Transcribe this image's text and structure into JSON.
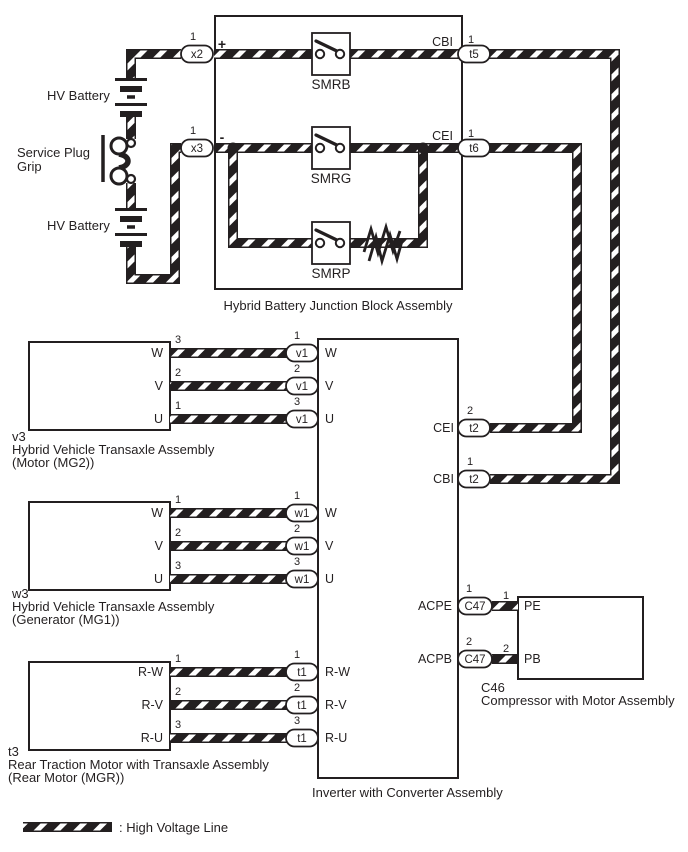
{
  "colors": {
    "ink": "#231f20",
    "background": "#ffffff",
    "hv_line_fill": "#ffffff"
  },
  "left_column": {
    "hv_battery_top": "HV Battery",
    "service_plug_line1": "Service Plug",
    "service_plug_line2": "Grip",
    "hv_battery_bottom": "HV Battery"
  },
  "junction_block": {
    "caption": "Hybrid Battery Junction Block Assembly",
    "x2": {
      "pin": "1",
      "label": "x2",
      "polarity": "+"
    },
    "x3": {
      "pin": "1",
      "label": "x3",
      "polarity": "-"
    },
    "t5": {
      "pin": "1",
      "label": "t5",
      "signal": "CBI"
    },
    "t6": {
      "pin": "1",
      "label": "t6",
      "signal": "CEI"
    },
    "relay_b": "SMRB",
    "relay_g": "SMRG",
    "relay_p": "SMRP"
  },
  "mg2": {
    "code": "v3",
    "caption_line1": "Hybrid Vehicle Transaxle Assembly",
    "caption_line2": "(Motor (MG2))",
    "rows": [
      {
        "phase": "W",
        "pin_out": "3",
        "pin_in": "1",
        "connector": "v1",
        "inverter_terminal": "W"
      },
      {
        "phase": "V",
        "pin_out": "2",
        "pin_in": "2",
        "connector": "v1",
        "inverter_terminal": "V"
      },
      {
        "phase": "U",
        "pin_out": "1",
        "pin_in": "3",
        "connector": "v1",
        "inverter_terminal": "U"
      }
    ]
  },
  "mg1": {
    "code": "w3",
    "caption_line1": "Hybrid Vehicle Transaxle Assembly",
    "caption_line2": "(Generator (MG1))",
    "rows": [
      {
        "phase": "W",
        "pin_out": "1",
        "pin_in": "1",
        "connector": "w1",
        "inverter_terminal": "W"
      },
      {
        "phase": "V",
        "pin_out": "2",
        "pin_in": "2",
        "connector": "w1",
        "inverter_terminal": "V"
      },
      {
        "phase": "U",
        "pin_out": "3",
        "pin_in": "3",
        "connector": "w1",
        "inverter_terminal": "U"
      }
    ]
  },
  "mgr": {
    "code": "t3",
    "caption_line1": "Rear Traction Motor with Transaxle Assembly",
    "caption_line2": "(Rear Motor (MGR))",
    "rows": [
      {
        "phase": "R-W",
        "pin_out": "1",
        "pin_in": "1",
        "connector": "t1",
        "inverter_terminal": "R-W"
      },
      {
        "phase": "R-V",
        "pin_out": "2",
        "pin_in": "2",
        "connector": "t1",
        "inverter_terminal": "R-V"
      },
      {
        "phase": "R-U",
        "pin_out": "3",
        "pin_in": "3",
        "connector": "t1",
        "inverter_terminal": "R-U"
      }
    ]
  },
  "inverter": {
    "caption": "Inverter with Converter Assembly",
    "cei": {
      "signal": "CEI",
      "pin": "2",
      "connector": "t2"
    },
    "cbi": {
      "signal": "CBI",
      "pin": "1",
      "connector": "t2"
    },
    "acpe": {
      "signal": "ACPE",
      "pin": "1",
      "connector": "C47",
      "box_pin": "1",
      "terminal": "PE"
    },
    "acpb": {
      "signal": "ACPB",
      "pin": "2",
      "connector": "C47",
      "box_pin": "2",
      "terminal": "PB"
    }
  },
  "compressor": {
    "code": "C46",
    "caption": "Compressor with Motor Assembly"
  },
  "legend": {
    "label": ": High Voltage Line"
  }
}
